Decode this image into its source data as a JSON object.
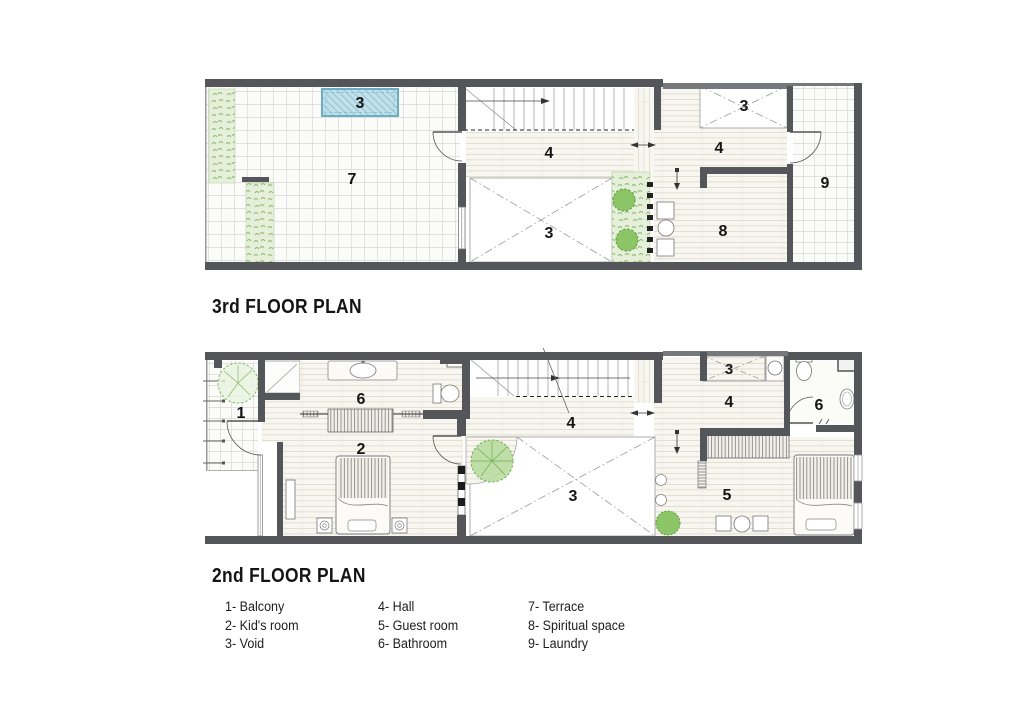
{
  "sheet": {
    "background": "#ffffff"
  },
  "plans": [
    {
      "id": "third-floor-plan",
      "title": "3rd FLOOR PLAN",
      "labels": {
        "void_skylight": "3",
        "terrace": "7",
        "hall_mid": "4",
        "void_mid": "3",
        "hall_right": "4",
        "void_right": "3",
        "spiritual_space": "8",
        "laundry": "9"
      }
    },
    {
      "id": "second-floor-plan",
      "title": "2nd FLOOR PLAN",
      "labels": {
        "balcony": "1",
        "bathroom_left": "6",
        "kids_room": "2",
        "hall_mid": "4",
        "void_mid": "3",
        "void_right": "3",
        "hall_right": "4",
        "guest_room": "5",
        "bathroom_right": "6"
      }
    }
  ],
  "legend": {
    "columns": [
      [
        "1- Balcony",
        "2- Kid's room",
        "3- Void"
      ],
      [
        "4- Hall",
        "5- Guest room",
        "6- Bathroom"
      ],
      [
        "7- Terrace",
        "8- Spiritual space",
        "9- Laundry"
      ]
    ]
  },
  "colors": {
    "wall": "#55565a",
    "floor_line": "#ddd5c6",
    "tile_line": "#d8d8d4",
    "pool_fill": "#c2e0ea",
    "pool_border": "#6aaec5",
    "plant_green": "#86b968",
    "void_cross": "#9b9b9b"
  }
}
